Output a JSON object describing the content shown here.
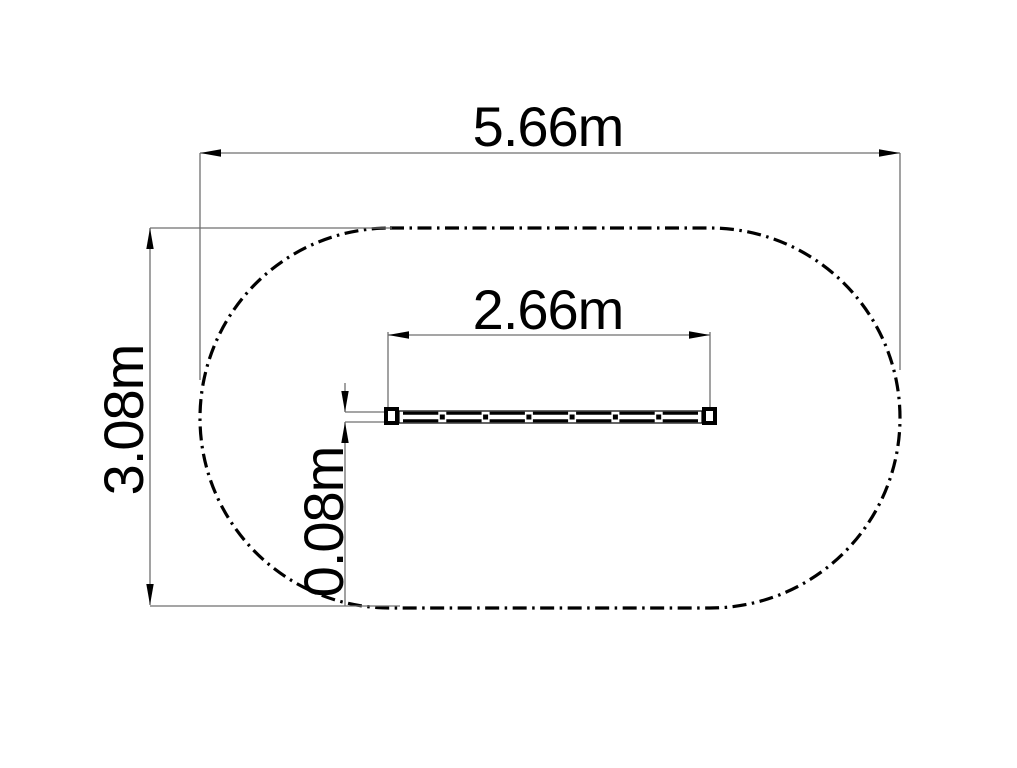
{
  "page": {
    "background": "#ffffff"
  },
  "drawing": {
    "type": "technical-plan-drawing",
    "boundary": {
      "shape": "stadium-oval",
      "line_style": "dash-dot",
      "color": "#000000"
    },
    "beam": {
      "shape": "segmented-beam-plan-view",
      "end_caps": "square",
      "segments": 7,
      "color": "#000000"
    },
    "colors": {
      "geometry": "#000000",
      "dimension_lines": "#6f6f6f",
      "text": "#000000"
    },
    "dimensions": {
      "overall_width": {
        "label": "5.66m",
        "value_m": 5.66,
        "orientation": "horizontal"
      },
      "overall_height": {
        "label": "3.08m",
        "value_m": 3.08,
        "orientation": "vertical"
      },
      "beam_length": {
        "label": "2.66m",
        "value_m": 2.66,
        "orientation": "horizontal"
      },
      "beam_thickness": {
        "label": "0.08m",
        "value_m": 0.08,
        "orientation": "vertical"
      }
    }
  }
}
